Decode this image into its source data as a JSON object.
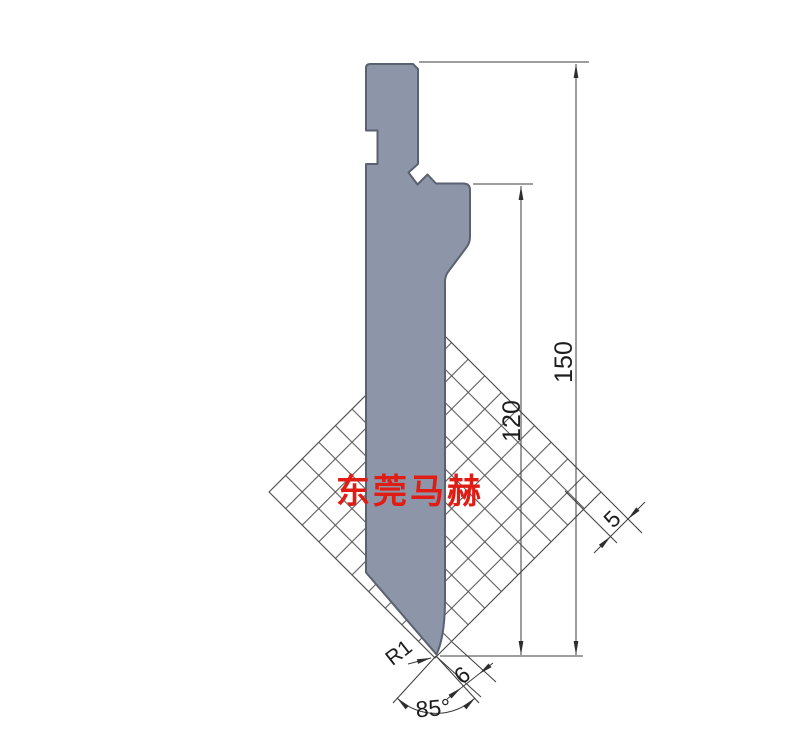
{
  "drawing": {
    "watermark": {
      "text": "东莞马赫",
      "color": "#e01d15"
    },
    "dimensions": {
      "total_height": "150",
      "working_height": "120",
      "grid_pitch": "5",
      "tip_offset": "6",
      "tip_radius": "R1",
      "tip_angle": "85°"
    },
    "colors": {
      "punch_fill": "#8d95a8",
      "punch_outline": "#5a6170",
      "dimension_line": "#3c3c3c",
      "hatch_line": "#505050",
      "background": "#ffffff"
    }
  }
}
